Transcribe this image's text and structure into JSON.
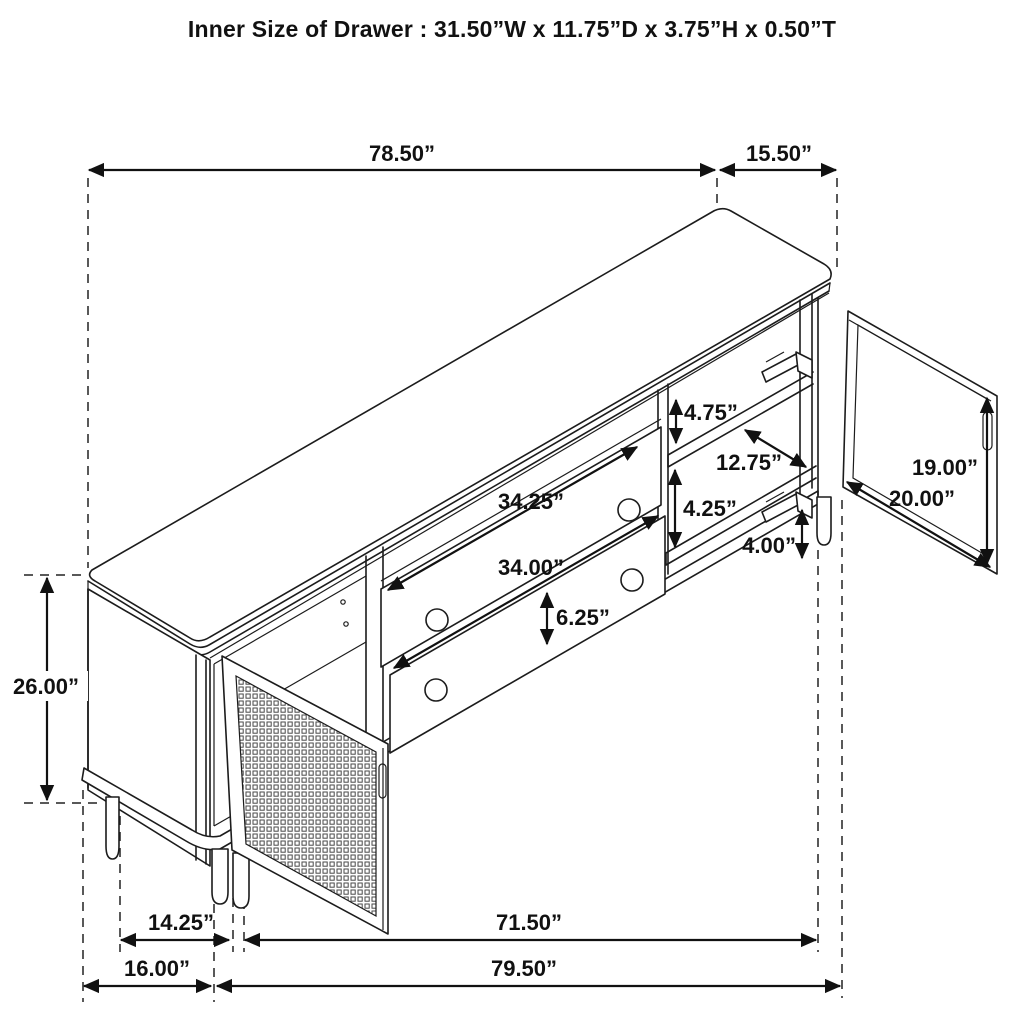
{
  "title": "Inner Size of Drawer : 31.50”W x 11.75”D x 3.75”H x 0.50”T",
  "diagram": {
    "type": "furniture-dimension-drawing",
    "subject": "sideboard-tv-console-isometric-line-art",
    "features": [
      "cabinet-top",
      "two-drawers-with-round-knobs",
      "open-cane-webbing-left-door",
      "open-right-door-with-hinges",
      "interior-shelves",
      "round-legs"
    ]
  },
  "dims": {
    "top_width": "78.50”",
    "top_depth": "15.50”",
    "open_shelf_height": "4.75”",
    "shelf_depth": "12.75”",
    "drawer_opening_width": "34.25”",
    "shelf_gap_height": "4.25”",
    "right_door_height": "19.00”",
    "right_door_width": "20.00”",
    "drawer_width": "34.00”",
    "leg_height": "4.00”",
    "drawer_front_height": "6.25”",
    "side_height": "26.00”",
    "leg_inset_depth": "14.25”",
    "front_leg_span": "71.50”",
    "base_depth": "16.00”",
    "overall_width": "79.50”"
  }
}
